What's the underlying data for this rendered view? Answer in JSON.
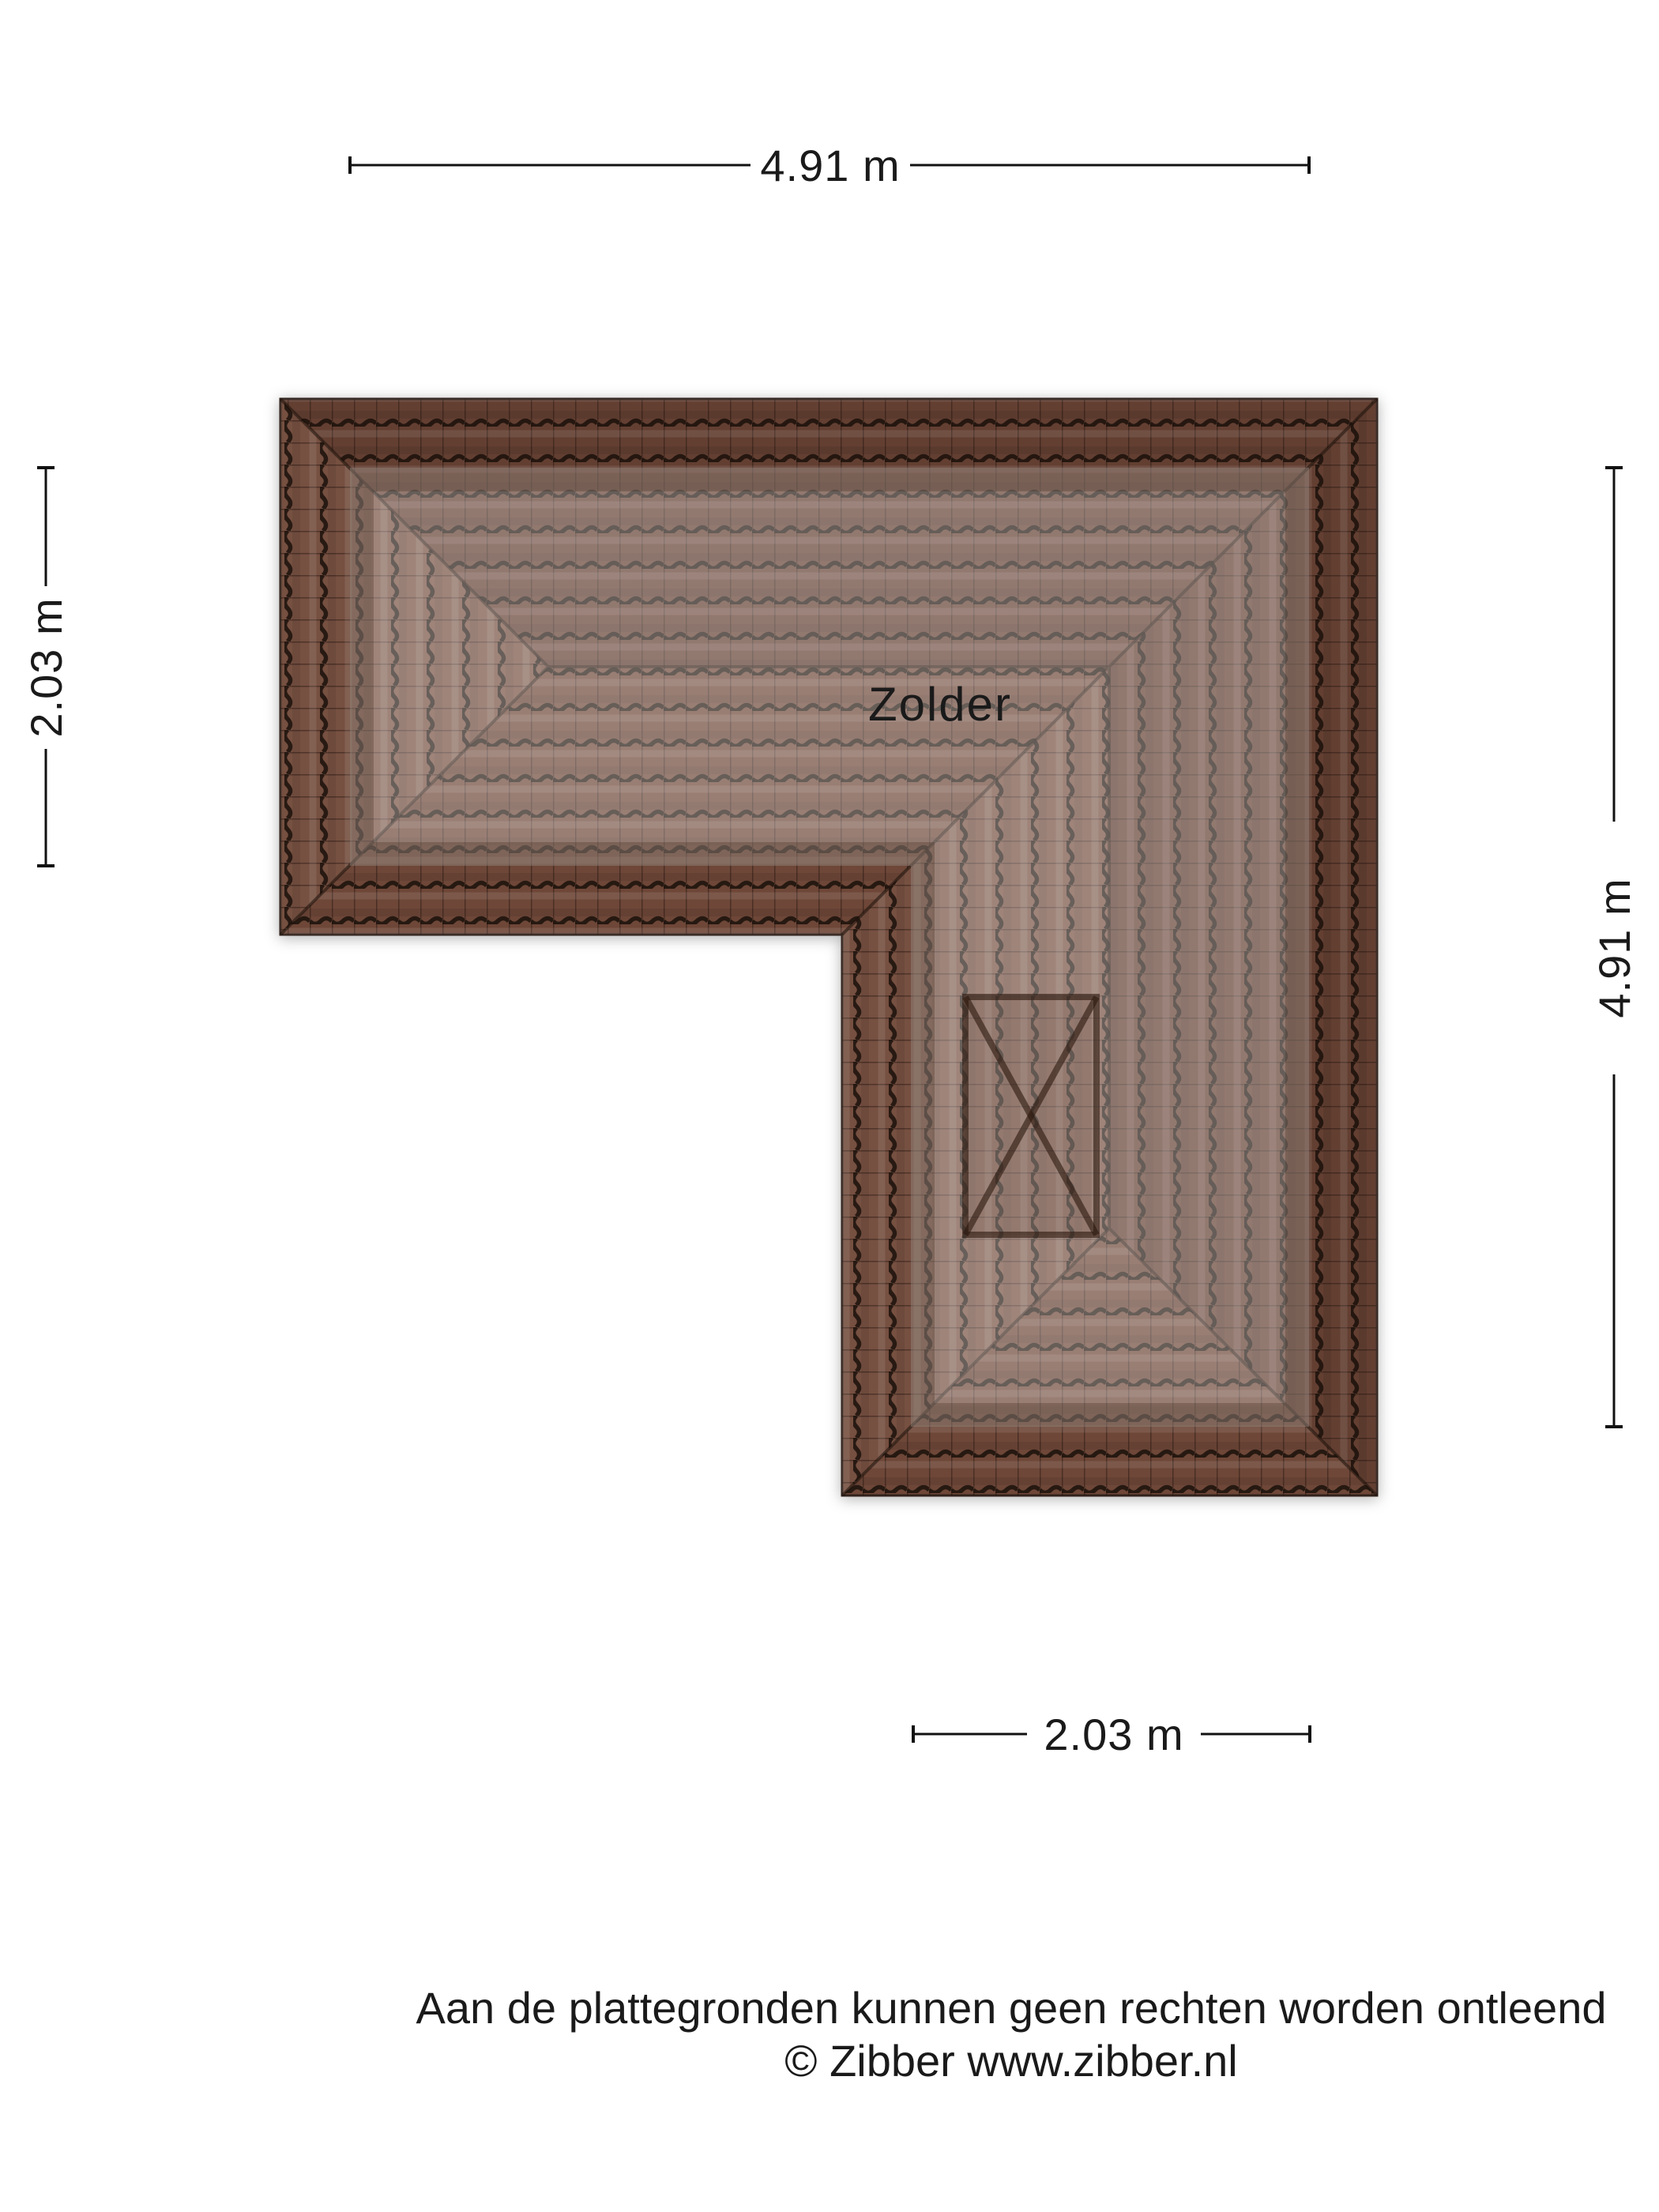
{
  "plan": {
    "room_label": "Zolder",
    "dimensions": {
      "top": "4.91 m",
      "left": "2.03 m",
      "right": "4.91 m",
      "bottom": "2.03 m"
    },
    "colors": {
      "tile_base": "#6e4737",
      "tile_joint": "#1a100a",
      "room_overlay": "#ffffff",
      "dimension_line": "#111111",
      "text": "#1a1a1a",
      "skylight_line": "#2c180e"
    }
  },
  "footer": {
    "line1": "Aan de plattegronden kunnen geen rechten worden ontleend",
    "line2": "© Zibber www.zibber.nl"
  }
}
